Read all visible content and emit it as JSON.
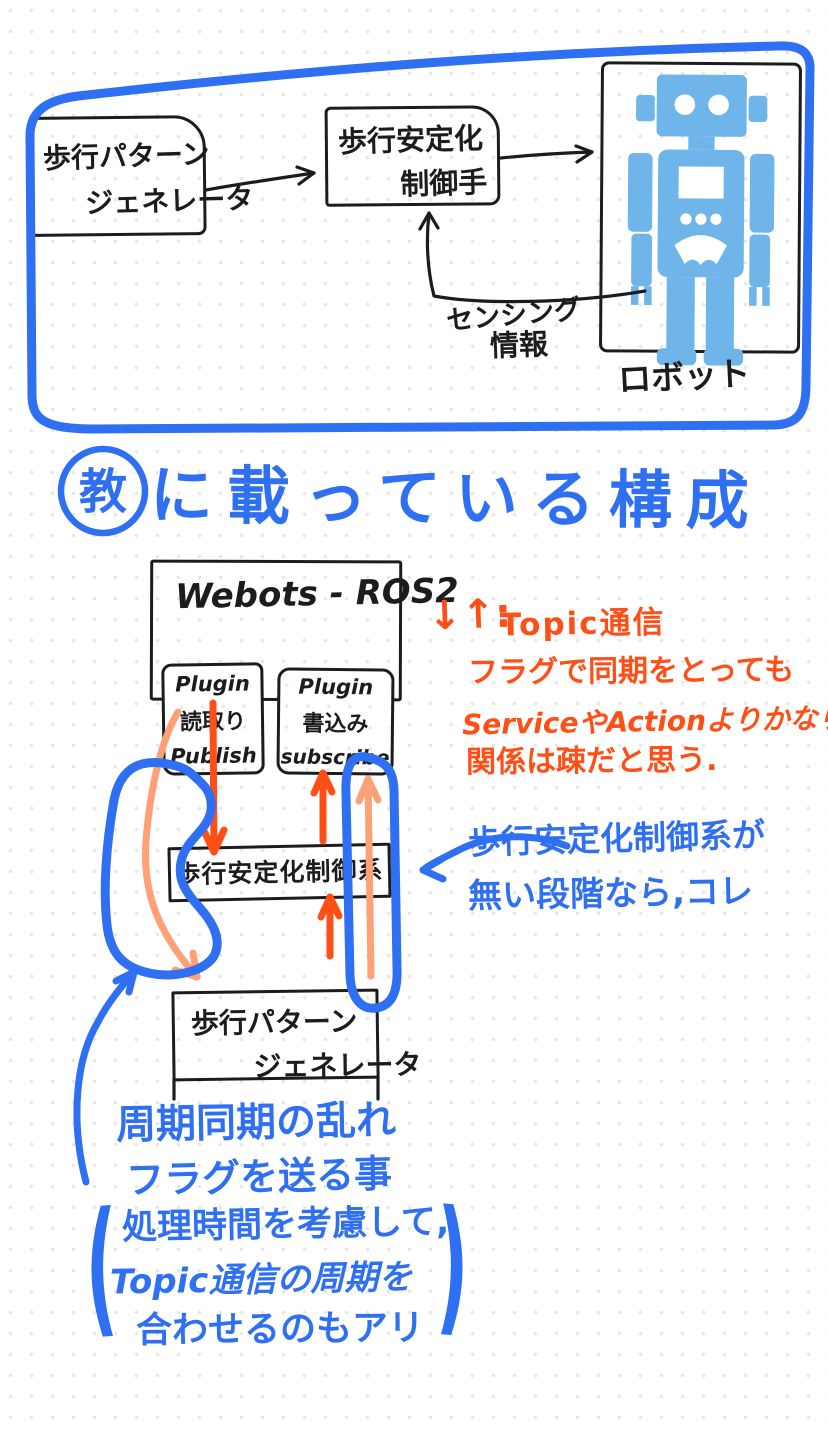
{
  "top_diagram": {
    "pattern_generator_box": {
      "line1": "歩行パターン",
      "line2": "ジェネレータ"
    },
    "stabilizer_box": {
      "line1": "歩行安定化",
      "line2": "制御手"
    },
    "robot_label": "ロボット",
    "sensing_label": {
      "line1": "センシング",
      "line2": "情報"
    }
  },
  "heading": {
    "circled_char": "教",
    "text": "に載っている構成"
  },
  "lower_diagram": {
    "webots_title": "Webots - ROS2",
    "plugin_read_box": {
      "line1": "Plugin",
      "line2": "読取り",
      "line3": "Publish"
    },
    "plugin_write_box": {
      "line1": "Plugin",
      "line2": "書込み",
      "line3": "subscribe"
    },
    "controller_box": "歩行安定化制御系",
    "pattern_generator_box": {
      "line1": "歩行パターン",
      "line2": "ジェネレータ"
    }
  },
  "orange_note": {
    "prefix": "↓↑:",
    "line1": "Topic通信",
    "line2": "フラグで同期をとっても",
    "line3": "ServiceやActionよりかなり",
    "line4": "関係は疎だと思う."
  },
  "blue_note_right": {
    "line1": "歩行安定化制御系が",
    "line2": "無い段階なら,コレ"
  },
  "blue_note_bottom": {
    "line1": "周期同期の乱れ",
    "line2": "フラグを送る事",
    "paren_open": "(",
    "line3": "処理時間を考慮して,",
    "line4": "Topic通信の周期を",
    "line5": "合わせるのもアリ",
    "paren_close": ")"
  },
  "colors": {
    "ink_blue": "#2f6ff2",
    "ink_black": "#1c1c1c",
    "ink_orange": "#ff4e16",
    "ink_salmon": "#ffa077",
    "robot_blue": "#6fb5e9"
  }
}
